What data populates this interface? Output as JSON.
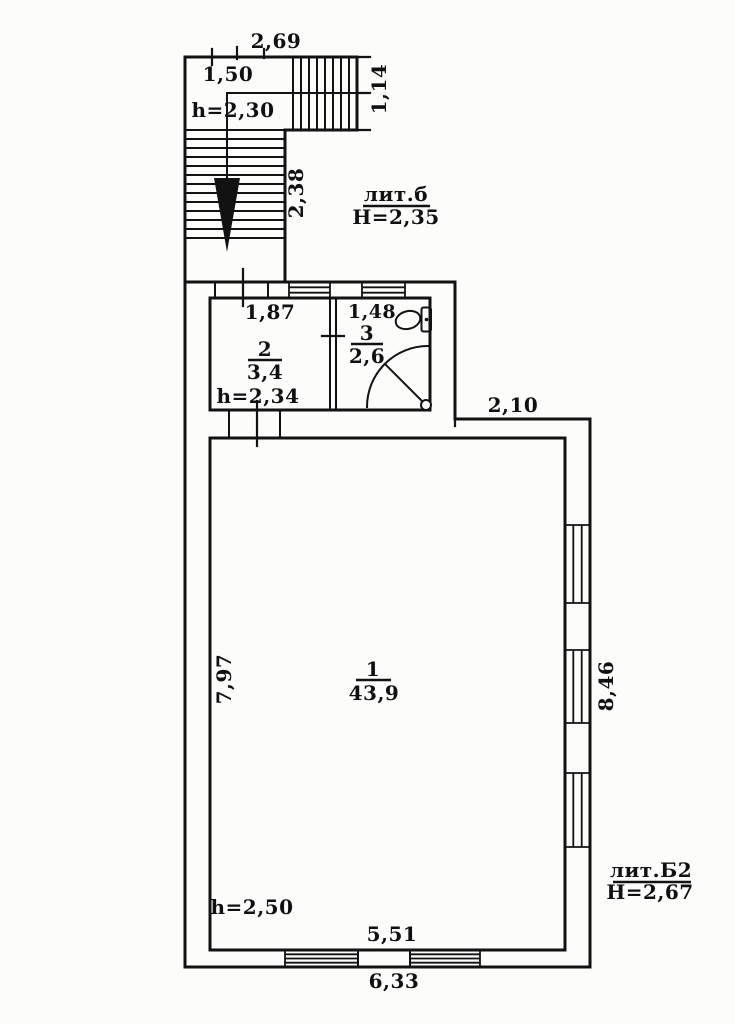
{
  "colors": {
    "ink": "#121212",
    "paper": "#fcfcfb"
  },
  "stair": {
    "total_width": "2,69",
    "landing_width": "1,50",
    "upper_flight_width": "1,14",
    "height_label": "h=2,30",
    "flight_length": "2,38"
  },
  "annex_b": {
    "liter": "лит.б",
    "height_label": "Н=2,35"
  },
  "building_b2": {
    "liter": "лит.Б2",
    "height_label": "Н=2,67"
  },
  "room1": {
    "number": "1",
    "area": "43,9",
    "height_label": "h=2,50",
    "top_width": "2,10",
    "inner_width": "5,51",
    "outer_width": "6,33",
    "left_depth": "7,97",
    "right_depth": "8,46"
  },
  "room2": {
    "number": "2",
    "area": "3,4",
    "height_label": "h=2,34",
    "width": "1,87"
  },
  "room3": {
    "number": "3",
    "area": "2,6",
    "width": "1,48"
  },
  "symbols": {
    "toilet": "toilet-icon",
    "shower": "shower-tray-icon",
    "stairs_direction": "stairs-down-arrow-icon"
  }
}
